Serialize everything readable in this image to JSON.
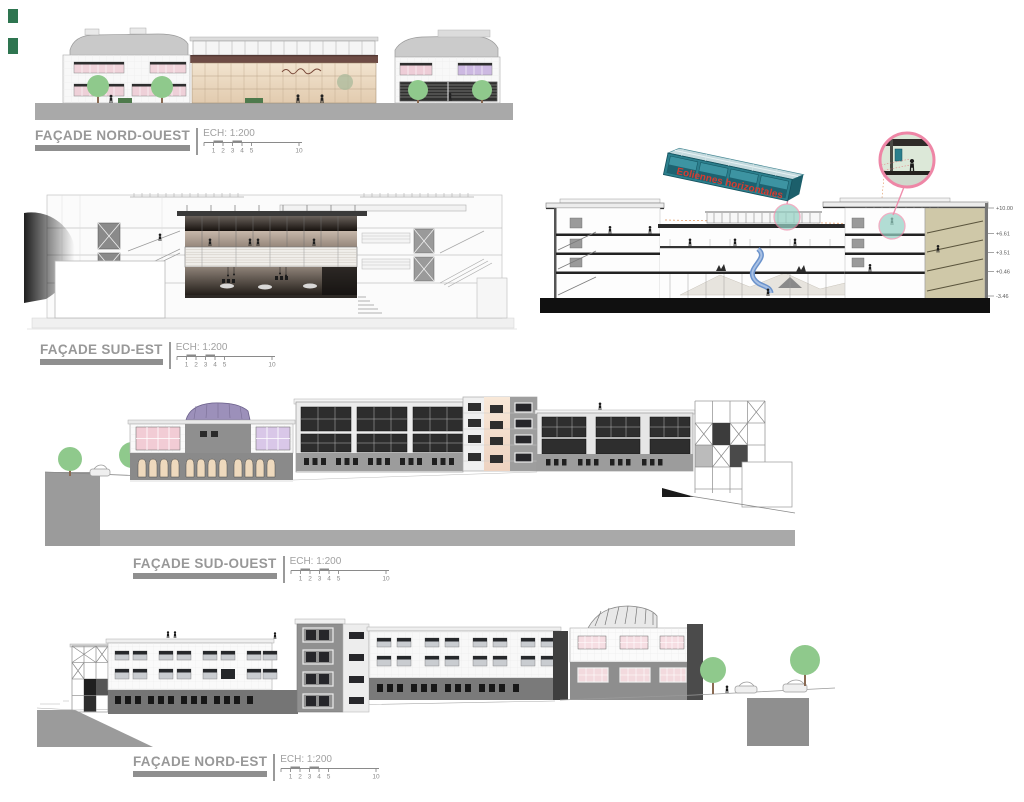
{
  "sheet": {
    "width": 1024,
    "height": 802,
    "background": "#ffffff"
  },
  "corner_marks": {
    "color": "#2e7550"
  },
  "labels": {
    "scale_label": "ECH: 1:200",
    "scale_ticks": [
      "1",
      "2",
      "3",
      "4",
      "5"
    ],
    "scale_end_tick": "10"
  },
  "elevations": [
    {
      "id": "facade-nord-ouest",
      "title": "FAÇADE NORD-OUEST"
    },
    {
      "id": "facade-sud-est",
      "title": "FAÇADE SUD-EST"
    },
    {
      "id": "facade-sud-ouest",
      "title": "FAÇADE SUD-OUEST"
    },
    {
      "id": "facade-nord-est",
      "title": "FAÇADE NORD-EST"
    }
  ],
  "section": {
    "annotation": "Eoliennes horizontales",
    "annotation_color": "#d63b30",
    "levels": [
      "+10.00",
      "+6.61",
      "+3.51",
      "+0.46",
      "-3.46"
    ]
  },
  "colors": {
    "callout_pink": "#ef8fad",
    "highlight_teal": "#96d2c5",
    "turbine_teal": "#2c7f8d",
    "tree_green": "#8fc98c",
    "ground_gray": "#a9a9a9",
    "label_gray": "#989898"
  }
}
